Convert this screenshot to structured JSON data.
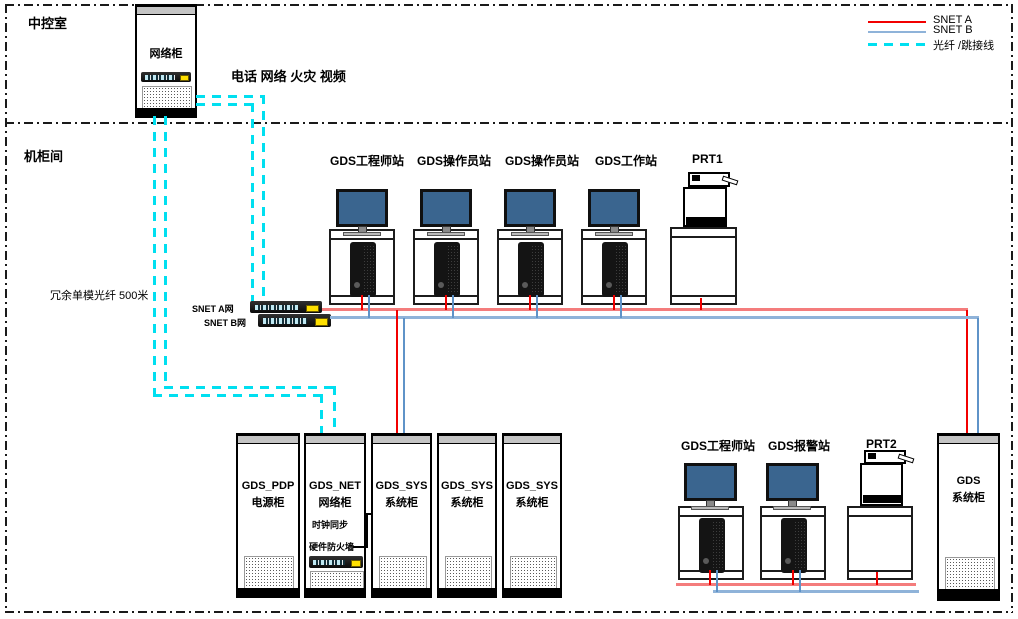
{
  "rooms": {
    "top": "中控室",
    "bottom": "机柜间"
  },
  "legend": {
    "items": [
      {
        "label": "SNET A",
        "color": "#f20000",
        "style": "solid"
      },
      {
        "label": "SNET B",
        "color": "#8fb3d9",
        "style": "solid"
      },
      {
        "label": "光纤 /跳接线",
        "color": "#00dff0",
        "style": "dashed"
      }
    ]
  },
  "annotations": {
    "services": "电话 网络 火灾 视频",
    "fiber_run": "冗余单模光纤 500米",
    "clock_sync": "时钟同步",
    "firewall": "硬件防火墙"
  },
  "control_cabinet": {
    "label": "网络柜"
  },
  "switches": {
    "a": "SNET A网",
    "b": "SNET B网"
  },
  "stations_top": [
    {
      "label": "GDS工程师站"
    },
    {
      "label": "GDS操作员站"
    },
    {
      "label": "GDS操作员站"
    },
    {
      "label": "GDS工作站"
    }
  ],
  "stations_bottom": [
    {
      "label": "GDS工程师站"
    },
    {
      "label": "GDS报警站"
    }
  ],
  "printers": {
    "prt1": "PRT1",
    "prt2": "PRT2"
  },
  "cabinets_bottom": [
    {
      "line1": "GDS_PDP",
      "line2": "电源柜"
    },
    {
      "line1": "GDS_NET",
      "line2": "网络柜"
    },
    {
      "line1": "GDS_SYS",
      "line2": "系统柜"
    },
    {
      "line1": "GDS_SYS",
      "line2": "系统柜"
    },
    {
      "line1": "GDS_SYS",
      "line2": "系统柜"
    }
  ],
  "cabinet_right": {
    "line1": "GDS",
    "line2": "系统柜"
  }
}
